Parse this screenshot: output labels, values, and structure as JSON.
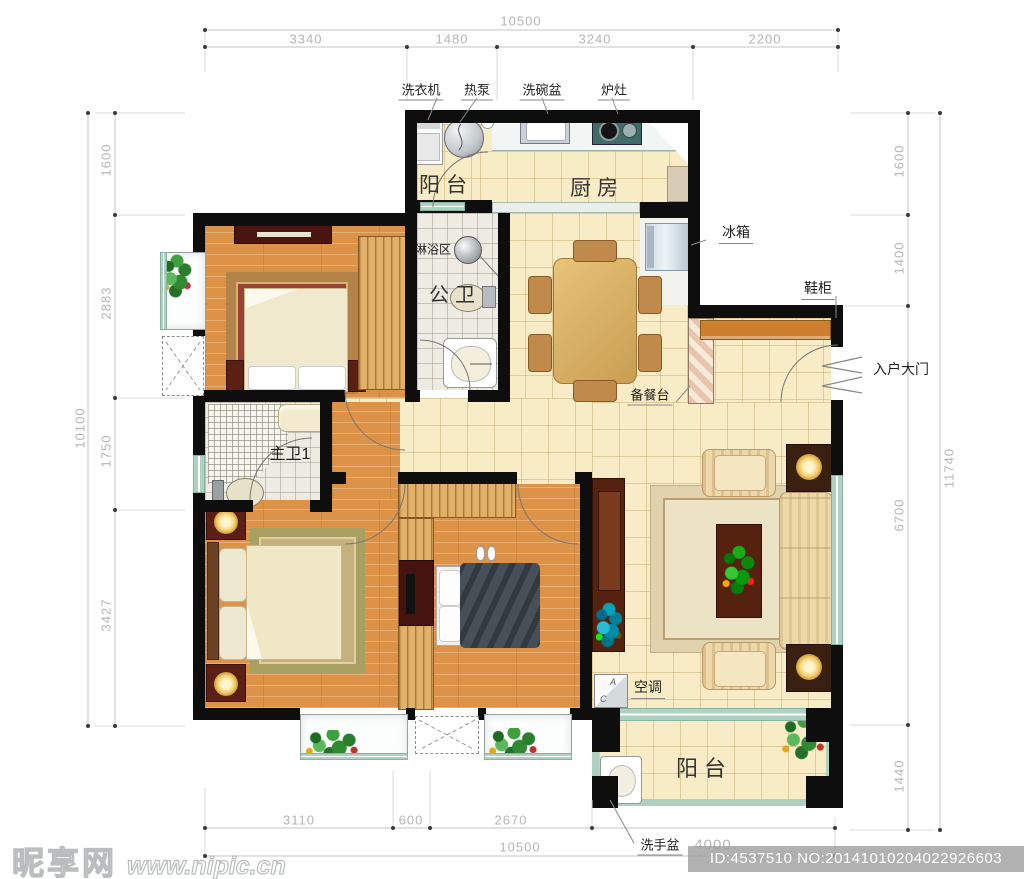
{
  "watermark": {
    "brand": "昵享网",
    "site": "www.nipic.cn",
    "id_line": "ID:4537510 NO:20141010204022926603"
  },
  "dims": {
    "top": {
      "total": "10500",
      "segs": [
        "3340",
        "1480",
        "3240",
        "2200"
      ]
    },
    "bottom": {
      "total": "10500",
      "segs": [
        "3110",
        "600",
        "2670",
        "4000"
      ]
    },
    "left": {
      "total": "10100",
      "segs": [
        "1600",
        "2883",
        "1750",
        "3427"
      ]
    },
    "right": {
      "total": "11740",
      "segs": [
        "1600",
        "1400",
        "6700",
        "1440"
      ]
    }
  },
  "rooms": {
    "balcony_top": "阳台",
    "kitchen": "厨房",
    "balcony_bottom": "阳台"
  },
  "labels": {
    "washing_machine": "洗衣机",
    "heat_pump": "热泵",
    "dish_basin": "洗碗盆",
    "stove": "炉灶",
    "fridge": "冰箱",
    "shoe_cabinet": "鞋柜",
    "entrance_door": "入户大门",
    "shower_area": "淋浴区",
    "public_bathroom": "公卫",
    "master_bathroom": "主卫1",
    "prep_counter": "备餐台",
    "air_conditioner": "空调",
    "hand_basin": "洗手盆"
  },
  "ac_unit": {
    "letter_a": "A",
    "letter_c": "C"
  },
  "colors": {
    "wall": "#0e0e0e",
    "wood_floor": "#dc9247",
    "tile_floor": "#f7ecc6",
    "bath_tile": "#edebe2",
    "window_frame": "#aed1c1",
    "furniture_dark": "#54220f",
    "shoe_cabinet_orange": "#cd7f2e"
  }
}
